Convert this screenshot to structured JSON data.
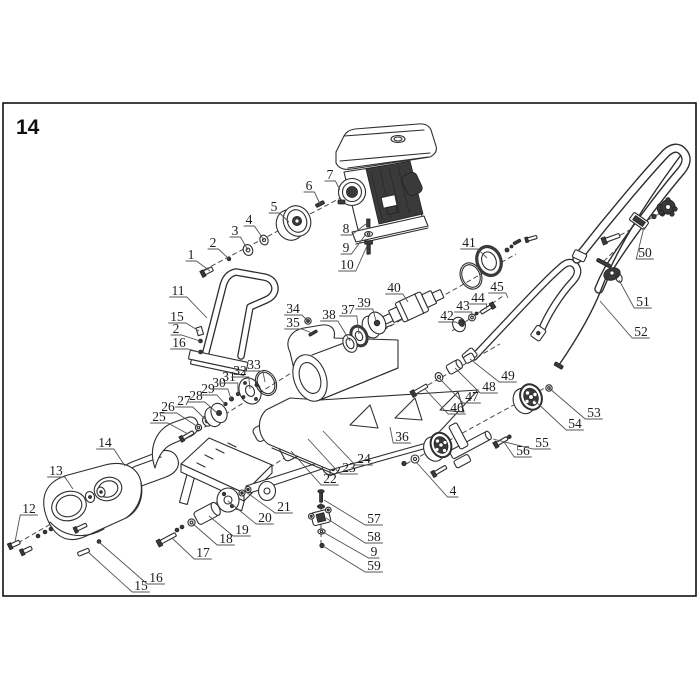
{
  "figure": {
    "number": "14"
  },
  "canvas": {
    "background": "#ffffff",
    "border_color": "#111111",
    "line_color": "#2e2e2e",
    "accent_dark": "#3a3a3a"
  },
  "diagram": {
    "type": "exploded-parts-diagram",
    "description_seen_in_pixels": "numbered exploded view of plate compactor style machine",
    "callouts": [
      {
        "label": "1",
        "x": 191,
        "y": 255,
        "tx": 210,
        "ty": 271
      },
      {
        "label": "2",
        "x": 213,
        "y": 243,
        "tx": 229,
        "ty": 259
      },
      {
        "label": "3",
        "x": 235,
        "y": 231,
        "tx": 248,
        "ty": 250
      },
      {
        "label": "4",
        "x": 249,
        "y": 220,
        "tx": 264,
        "ty": 240
      },
      {
        "label": "5",
        "x": 274,
        "y": 207,
        "tx": 289,
        "ty": 222
      },
      {
        "label": "6",
        "x": 309,
        "y": 186,
        "tx": 320,
        "ty": 204
      },
      {
        "label": "7",
        "x": 330,
        "y": 175,
        "tx": 340,
        "ty": 190
      },
      {
        "label": "8",
        "x": 346,
        "y": 229,
        "tx": 366,
        "ty": 224
      },
      {
        "label": "9",
        "x": 346,
        "y": 248,
        "tx": 366,
        "ty": 234
      },
      {
        "label": "10",
        "x": 347,
        "y": 265,
        "tx": 367,
        "ty": 246
      },
      {
        "label": "11",
        "x": 178,
        "y": 291,
        "tx": 207,
        "ty": 318
      },
      {
        "label": "15",
        "x": 177,
        "y": 317,
        "tx": 199,
        "ty": 331
      },
      {
        "label": "2",
        "x": 176,
        "y": 329,
        "tx": 200,
        "ty": 341
      },
      {
        "label": "16",
        "x": 179,
        "y": 343,
        "tx": 200,
        "ty": 352
      },
      {
        "label": "12",
        "x": 29,
        "y": 509,
        "tx": 15,
        "ty": 542
      },
      {
        "label": "13",
        "x": 56,
        "y": 471,
        "tx": 73,
        "ty": 489
      },
      {
        "label": "14",
        "x": 105,
        "y": 443,
        "tx": 125,
        "ty": 466
      },
      {
        "label": "15",
        "x": 141,
        "y": 586,
        "tx": 88,
        "ty": 552
      },
      {
        "label": "16",
        "x": 156,
        "y": 578,
        "tx": 99,
        "ty": 542
      },
      {
        "label": "17",
        "x": 203,
        "y": 553,
        "tx": 172,
        "ty": 538
      },
      {
        "label": "18",
        "x": 226,
        "y": 539,
        "tx": 192,
        "ty": 523
      },
      {
        "label": "19",
        "x": 242,
        "y": 530,
        "tx": 209,
        "ty": 516
      },
      {
        "label": "20",
        "x": 265,
        "y": 518,
        "tx": 228,
        "ty": 501
      },
      {
        "label": "21",
        "x": 284,
        "y": 507,
        "tx": 246,
        "ty": 492
      },
      {
        "label": "22",
        "x": 330,
        "y": 479,
        "tx": 291,
        "ty": 451
      },
      {
        "label": "23",
        "x": 349,
        "y": 468,
        "tx": 308,
        "ty": 439
      },
      {
        "label": "24",
        "x": 364,
        "y": 459,
        "tx": 323,
        "ty": 431
      },
      {
        "label": "25",
        "x": 159,
        "y": 417,
        "tx": 188,
        "ty": 434
      },
      {
        "label": "26",
        "x": 168,
        "y": 407,
        "tx": 198,
        "ty": 427
      },
      {
        "label": "27",
        "x": 184,
        "y": 401,
        "tx": 207,
        "ty": 421
      },
      {
        "label": "28",
        "x": 196,
        "y": 396,
        "tx": 217,
        "ty": 413
      },
      {
        "label": "29",
        "x": 208,
        "y": 389,
        "tx": 225,
        "ty": 404
      },
      {
        "label": "30",
        "x": 219,
        "y": 383,
        "tx": 231,
        "ty": 399
      },
      {
        "label": "31",
        "x": 229,
        "y": 377,
        "tx": 238,
        "ty": 394
      },
      {
        "label": "32",
        "x": 240,
        "y": 371,
        "tx": 250,
        "ty": 389
      },
      {
        "label": "33",
        "x": 254,
        "y": 365,
        "tx": 265,
        "ty": 382
      },
      {
        "label": "34",
        "x": 293,
        "y": 309,
        "tx": 308,
        "ty": 321
      },
      {
        "label": "35",
        "x": 293,
        "y": 323,
        "tx": 312,
        "ty": 333
      },
      {
        "label": "36",
        "x": 402,
        "y": 437,
        "tx": 390,
        "ty": 427
      },
      {
        "label": "37",
        "x": 348,
        "y": 310,
        "tx": 359,
        "ty": 334
      },
      {
        "label": "38",
        "x": 329,
        "y": 315,
        "tx": 350,
        "ty": 341
      },
      {
        "label": "39",
        "x": 364,
        "y": 303,
        "tx": 376,
        "ty": 321
      },
      {
        "label": "40",
        "x": 394,
        "y": 288,
        "tx": 408,
        "ty": 302
      },
      {
        "label": "41",
        "x": 469,
        "y": 243,
        "tx": 487,
        "ty": 258
      },
      {
        "label": "42",
        "x": 447,
        "y": 316,
        "tx": 459,
        "ty": 324
      },
      {
        "label": "43",
        "x": 463,
        "y": 306,
        "tx": 472,
        "ty": 317
      },
      {
        "label": "44",
        "x": 478,
        "y": 298,
        "tx": 486,
        "ty": 309
      },
      {
        "label": "45",
        "x": 497,
        "y": 287,
        "tx": 508,
        "ty": 298
      },
      {
        "label": "46",
        "x": 457,
        "y": 408,
        "tx": 425,
        "ty": 389
      },
      {
        "label": "47",
        "x": 472,
        "y": 397,
        "tx": 439,
        "ty": 378
      },
      {
        "label": "48",
        "x": 489,
        "y": 387,
        "tx": 455,
        "ty": 368
      },
      {
        "label": "49",
        "x": 508,
        "y": 376,
        "tx": 470,
        "ty": 359
      },
      {
        "label": "50",
        "x": 645,
        "y": 253,
        "tx": 644,
        "ty": 227
      },
      {
        "label": "51",
        "x": 643,
        "y": 302,
        "tx": 619,
        "ty": 280
      },
      {
        "label": "52",
        "x": 641,
        "y": 332,
        "tx": 600,
        "ty": 301
      },
      {
        "label": "53",
        "x": 594,
        "y": 413,
        "tx": 549,
        "ty": 388
      },
      {
        "label": "54",
        "x": 575,
        "y": 424,
        "tx": 534,
        "ty": 400
      },
      {
        "label": "55",
        "x": 542,
        "y": 443,
        "tx": 493,
        "ty": 439
      },
      {
        "label": "56",
        "x": 523,
        "y": 451,
        "tx": 504,
        "ty": 442
      },
      {
        "label": "57",
        "x": 374,
        "y": 519,
        "tx": 324,
        "ty": 500
      },
      {
        "label": "58",
        "x": 374,
        "y": 537,
        "tx": 326,
        "ty": 518
      },
      {
        "label": "9",
        "x": 374,
        "y": 552,
        "tx": 323,
        "ty": 532
      },
      {
        "label": "59",
        "x": 374,
        "y": 566,
        "tx": 323,
        "ty": 546
      },
      {
        "label": "4",
        "x": 453,
        "y": 491,
        "tx": 417,
        "ty": 463
      }
    ]
  }
}
